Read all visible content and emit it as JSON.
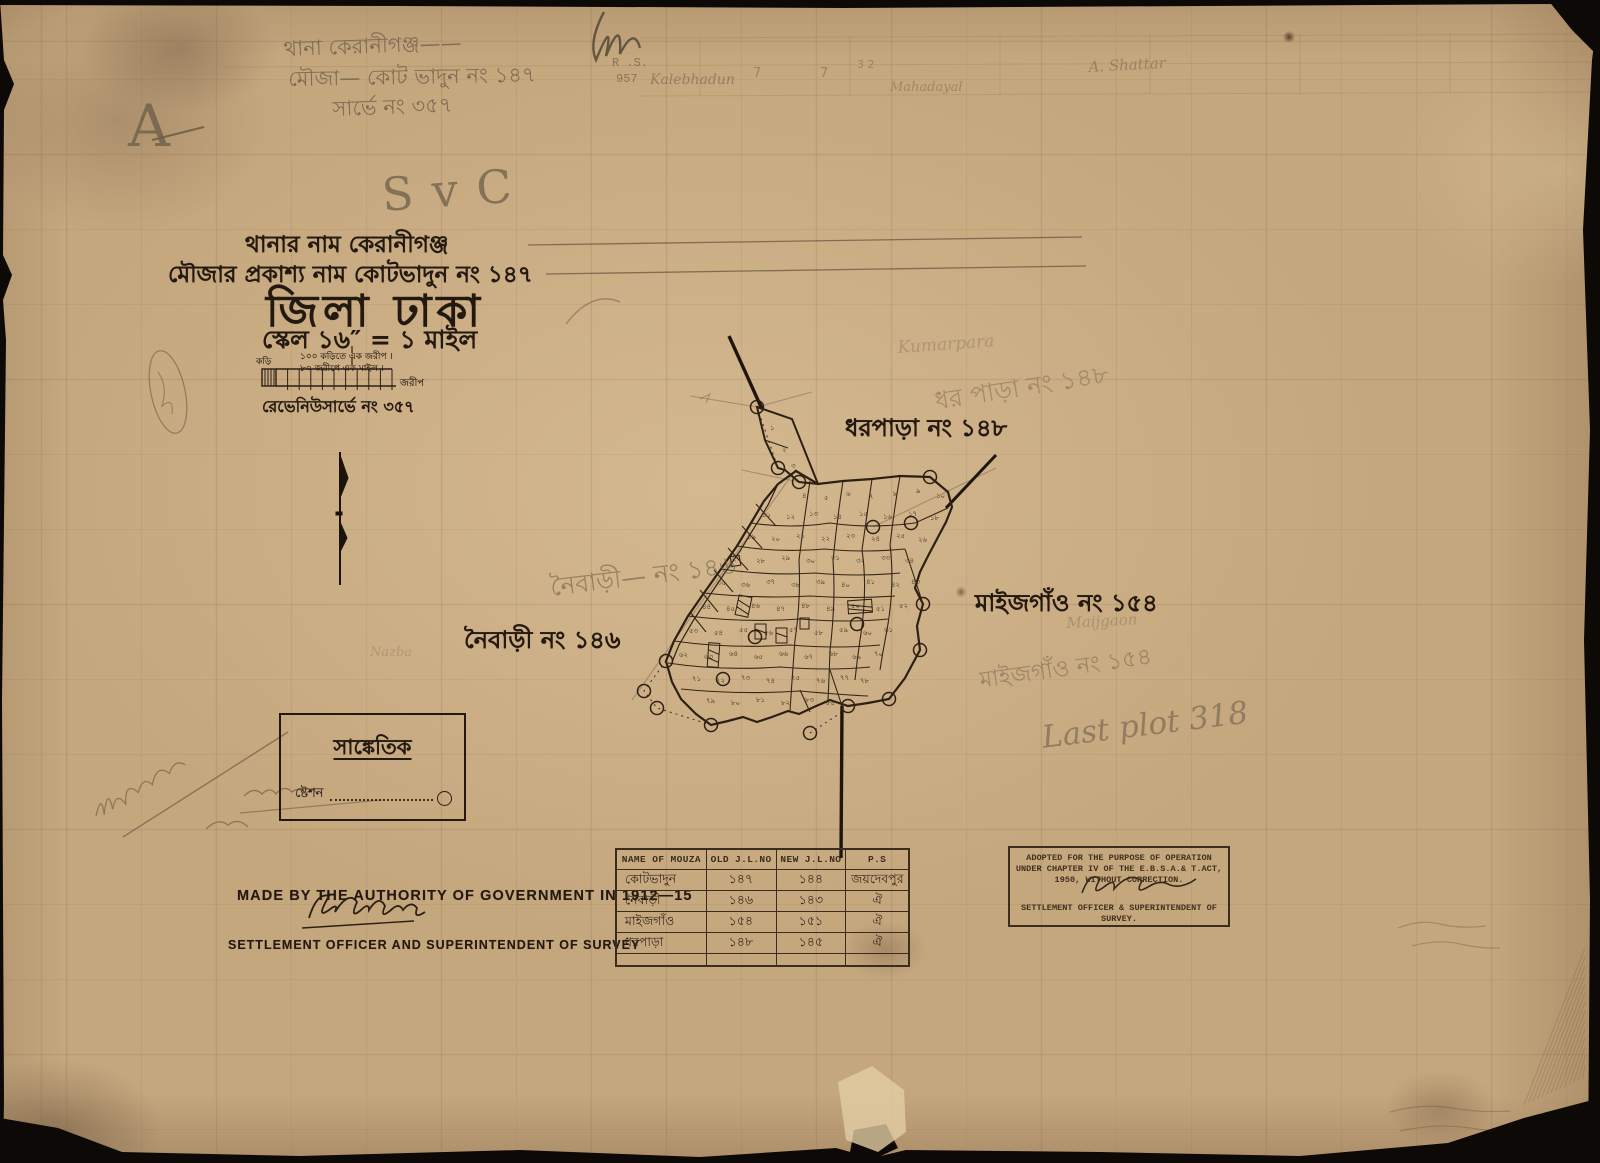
{
  "page_colors": {
    "paper": "#c5a77e",
    "ink": "#241910",
    "pencil": "#6e5f4a"
  },
  "header": {
    "thana_line": "থানার নাম  কেরানীগঞ্জ",
    "mouza_line": "মৌজার প্রকাশ্য নাম  কোটভাদুন নং ১৪৭",
    "district_line": "জিলা ঢাকা",
    "scale_line": "স্কেল ১৬″ = ১ মাইল",
    "scalebar_top": "১০০ কড়িতে এক জরীপ  ।",
    "scalebar_bottom": "৮০ জরীপে এক মাইল  ।",
    "scalebar_left": "কড়ি",
    "scalebar_right": "জরীপ",
    "revenue_line": "রেভেনিউসার্ভে নং ৩৫৭"
  },
  "map": {
    "label_dharpara": "ধরপাড়া নং ১৪৮",
    "label_maijgaon": "মাইজগাঁও নং ১৫৪",
    "label_naibari": "নৈবাড়ী নং ১৪৬",
    "stations": [
      [
        757,
        407
      ],
      [
        778,
        468
      ],
      [
        799,
        482
      ],
      [
        930,
        477
      ],
      [
        911,
        523
      ],
      [
        873,
        527
      ],
      [
        923,
        604
      ],
      [
        920,
        650
      ],
      [
        889,
        699
      ],
      [
        848,
        706
      ],
      [
        810,
        733
      ],
      [
        711,
        725
      ],
      [
        666,
        661
      ],
      [
        657,
        708
      ],
      [
        644,
        691
      ],
      [
        755,
        637
      ],
      [
        723,
        679
      ],
      [
        857,
        624
      ]
    ],
    "plot_numbers": [
      [
        770,
        430,
        "১"
      ],
      [
        782,
        452,
        "২"
      ],
      [
        791,
        468,
        "৩"
      ],
      [
        802,
        498,
        "৪"
      ],
      [
        824,
        500,
        "৫"
      ],
      [
        846,
        496,
        "৬"
      ],
      [
        869,
        499,
        "৭"
      ],
      [
        893,
        496,
        "৮"
      ],
      [
        916,
        493,
        "৯"
      ],
      [
        936,
        498,
        "১০"
      ],
      [
        762,
        517,
        "১১"
      ],
      [
        786,
        519,
        "১২"
      ],
      [
        809,
        516,
        "১৩"
      ],
      [
        833,
        519,
        "১৪"
      ],
      [
        859,
        516,
        "১৫"
      ],
      [
        883,
        519,
        "১৬"
      ],
      [
        908,
        516,
        "১৭"
      ],
      [
        930,
        520,
        "১৮"
      ],
      [
        747,
        539,
        "১৯"
      ],
      [
        771,
        541,
        "২০"
      ],
      [
        796,
        538,
        "২১"
      ],
      [
        821,
        541,
        "২২"
      ],
      [
        846,
        538,
        "২৩"
      ],
      [
        871,
        541,
        "২৪"
      ],
      [
        896,
        538,
        "২৫"
      ],
      [
        918,
        542,
        "২৬"
      ],
      [
        732,
        561,
        "২৭"
      ],
      [
        756,
        563,
        "২৮"
      ],
      [
        781,
        560,
        "২৯"
      ],
      [
        806,
        563,
        "৩০"
      ],
      [
        831,
        560,
        "৩১"
      ],
      [
        856,
        563,
        "৩২"
      ],
      [
        881,
        560,
        "৩৩"
      ],
      [
        905,
        563,
        "৩৪"
      ],
      [
        717,
        585,
        "৩৫"
      ],
      [
        741,
        587,
        "৩৬"
      ],
      [
        766,
        584,
        "৩৭"
      ],
      [
        791,
        587,
        "৩৮"
      ],
      [
        816,
        584,
        "৩৯"
      ],
      [
        841,
        587,
        "৪০"
      ],
      [
        866,
        584,
        "৪১"
      ],
      [
        891,
        587,
        "৪২"
      ],
      [
        911,
        584,
        "৪৩"
      ],
      [
        702,
        609,
        "৪৪"
      ],
      [
        726,
        611,
        "৪৫"
      ],
      [
        751,
        608,
        "৪৬"
      ],
      [
        776,
        611,
        "৪৭"
      ],
      [
        801,
        608,
        "৪৮"
      ],
      [
        826,
        611,
        "৪৯"
      ],
      [
        851,
        608,
        "৫০"
      ],
      [
        876,
        611,
        "৫১"
      ],
      [
        899,
        608,
        "৫২"
      ],
      [
        689,
        633,
        "৫৩"
      ],
      [
        714,
        635,
        "৫৪"
      ],
      [
        739,
        632,
        "৫৫"
      ],
      [
        764,
        635,
        "৫৬"
      ],
      [
        789,
        632,
        "৫৭"
      ],
      [
        814,
        635,
        "৫৮"
      ],
      [
        839,
        632,
        "৫৯"
      ],
      [
        863,
        635,
        "৬০"
      ],
      [
        884,
        632,
        "৬১"
      ],
      [
        679,
        657,
        "৬২"
      ],
      [
        704,
        659,
        "৬৩"
      ],
      [
        729,
        656,
        "৬৪"
      ],
      [
        754,
        659,
        "৬৫"
      ],
      [
        779,
        656,
        "৬৬"
      ],
      [
        804,
        659,
        "৬৭"
      ],
      [
        829,
        656,
        "৬৮"
      ],
      [
        852,
        659,
        "৬৯"
      ],
      [
        874,
        656,
        "৭০"
      ],
      [
        692,
        681,
        "৭১"
      ],
      [
        716,
        683,
        "৭২"
      ],
      [
        741,
        680,
        "৭৩"
      ],
      [
        766,
        683,
        "৭৪"
      ],
      [
        791,
        680,
        "৭৫"
      ],
      [
        816,
        683,
        "৭৬"
      ],
      [
        840,
        680,
        "৭৭"
      ],
      [
        860,
        683,
        "৭৮"
      ],
      [
        706,
        703,
        "৭৯"
      ],
      [
        731,
        705,
        "৮০"
      ],
      [
        756,
        702,
        "৮১"
      ],
      [
        781,
        705,
        "৮২"
      ],
      [
        805,
        702,
        "৮৩"
      ],
      [
        826,
        705,
        "৮৪"
      ]
    ]
  },
  "legend": {
    "title": "সাঙ্কেতিক",
    "station_label": "ষ্টেশন"
  },
  "footer": {
    "made_by": "MADE BY THE AUTHORITY OF GOVERNMENT IN 1912—15",
    "officer": "SETTLEMENT OFFICER AND SUPERINTENDENT OF SURVEY"
  },
  "table": {
    "headers": [
      "NAME OF MOUZA",
      "OLD J.L.NO",
      "NEW J.L.NO",
      "P.S"
    ],
    "rows": [
      [
        "কোটভাদুন",
        "১৪৭",
        "১৪৪",
        "জয়দেবপুর"
      ],
      [
        "নৈবাড়ী",
        "১৪৬",
        "১৪৩",
        "ঐ"
      ],
      [
        "মাইজগাঁও",
        "১৫৪",
        "১৫১",
        "ঐ"
      ],
      [
        "ধরপাড়া",
        "১৪৮",
        "১৪৫",
        "ঐ"
      ]
    ]
  },
  "stamp": {
    "line1": "ADOPTED FOR THE PURPOSE OF OPERATION",
    "line2": "UNDER CHAPTER IV OF THE E.B.S.A.& T.ACT,",
    "line3": "1950, WITHOUT CORRECTION.",
    "line4": "SETTLEMENT OFFICER & SUPERINTENDENT OF",
    "line5": "SURVEY."
  },
  "pencil_notes": {
    "corner_a": "A",
    "nb_monogram": "NB",
    "top1": "থানা কেরানীগঞ্জ——",
    "top2": "মৌজা— কোট ভাদুন  নং ১৪৭",
    "top3": "সার্ভে নং ৩৫৭",
    "svc": "S v C",
    "rs": "R .S.",
    "rs_no": "957",
    "kalebhadun": "Kalebhadun",
    "seven_a": "7",
    "seven_b": "7",
    "thirtytwo": "3 2",
    "mahadayal": "Mahadayal",
    "shattar": "A. Shattar",
    "naibari_note": "নৈবাড়ী— নং ১৪৬",
    "dharpara_note": "ধর পাড়া নং ১৪৮",
    "kumarpara": "Kumarpara",
    "maijgaon_en": "Maijgaon",
    "maijgaon_bn": "মাইজগাঁও  নং ১৫৪",
    "last_plot": "Last plot  318",
    "nazba": "Nazba"
  }
}
